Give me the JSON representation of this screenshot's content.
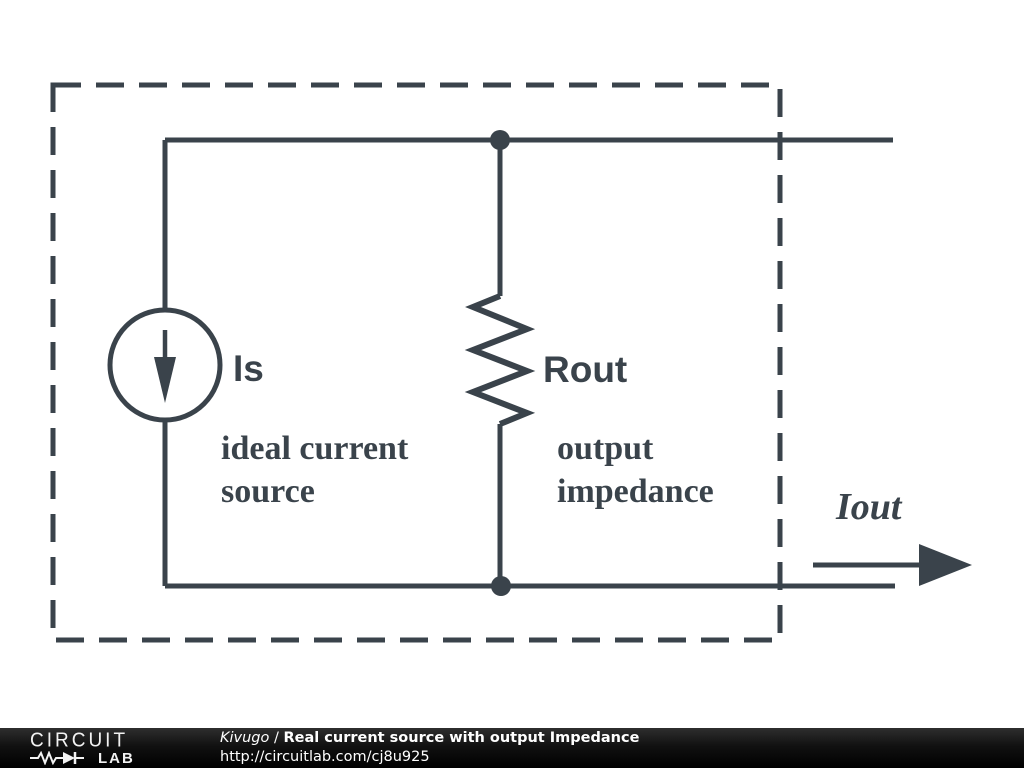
{
  "circuit": {
    "source_label": "Is",
    "source_caption_1": "ideal current",
    "source_caption_2": "source",
    "resistor_label": "Rout",
    "resistor_caption_1": "output",
    "resistor_caption_2": "impedance",
    "output_label": "Iout",
    "stroke_color": "#3a434b",
    "background_color": "#ffffff"
  },
  "footer": {
    "logo_top": "CIRCUIT",
    "logo_bottom": "LAB",
    "author": "Kivugo",
    "separator": " / ",
    "schematic_title": "Real current source with output Impedance",
    "url": "http://circuitlab.com/cj8u925",
    "bar_color": "#111111",
    "text_color": "#ffffff"
  }
}
